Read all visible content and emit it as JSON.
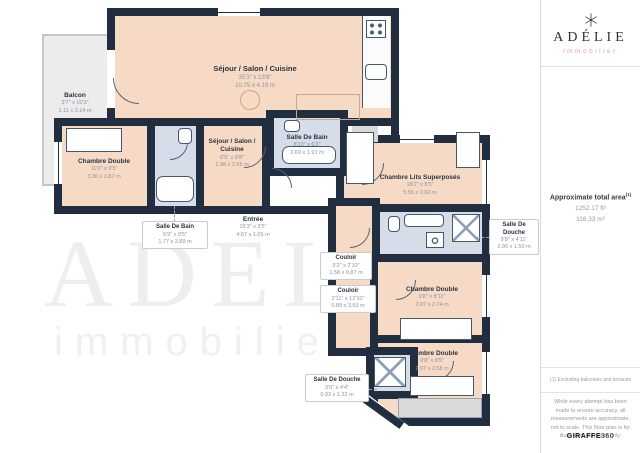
{
  "colors": {
    "wall": "#202e3f",
    "room_peach": "#f7dac5",
    "room_blue": "#d6dde8",
    "balcony_gray": "#ececec",
    "accent_pink": "#d9a3a3"
  },
  "watermark": {
    "line1": "ADELIE",
    "line2": "immobilier"
  },
  "rooms": {
    "balcon": {
      "name": "Balcon",
      "imperial": "3'7\" x 10'3\"",
      "metric": "1.11 x 3.14 m"
    },
    "sejour_main": {
      "name": "Séjour / Salon / Cuisine",
      "imperial": "35'3\" x 13'8\"",
      "metric": "10.75 x 4.19 m"
    },
    "chambre_left": {
      "name": "Chambre Double",
      "imperial": "11'0\" x 9'5\"",
      "metric": "3.36 x 2.87 m"
    },
    "sdb_left": {
      "name": "Salle De Bain",
      "imperial": "5'9\" x 9'5\"",
      "metric": "1.77 x 2.89 m"
    },
    "sejour_small": {
      "name": "Séjour / Salon / Cuisine",
      "imperial": "6'5\" x 8'8\"",
      "metric": "1.98 x 2.65 m"
    },
    "sdb_top": {
      "name": "Salle De Bain",
      "imperial": "8'10\" x 6'3\"",
      "metric": "2.69 x 1.91 m"
    },
    "entree": {
      "name": "Entrée",
      "imperial": "15'3\" x 3'5\"",
      "metric": "4.67 x 1.05 m"
    },
    "lits": {
      "name": "Chambre Lits Superposés",
      "imperial": "18'2\" x 8'5\"",
      "metric": "5.55 x 2.60 m"
    },
    "sdd_right": {
      "name": "Salle De Douche",
      "imperial": "9'8\" x 4'11\"",
      "metric": "2.96 x 1.50 m"
    },
    "couloir1": {
      "name": "Couloir",
      "imperial": "5'2\" x 2'10\"",
      "metric": "1.58 x 0.87 m"
    },
    "couloir2": {
      "name": "Couloir",
      "imperial": "2'11\" x 12'10\"",
      "metric": "0.89 x 3.93 m"
    },
    "chambre_mid": {
      "name": "Chambre Double",
      "imperial": "9'8\" x 8'11\"",
      "metric": "2.97 x 2.74 m"
    },
    "chambre_bottom": {
      "name": "Chambre Double",
      "imperial": "9'8\" x 8'5\"",
      "metric": "2.97 x 2.58 m"
    },
    "sdd_bottom": {
      "name": "Salle De Douche",
      "imperial": "3'0\" x 4'4\"",
      "metric": "0.93 x 1.32 m"
    }
  },
  "sidebar": {
    "brand": {
      "name": "ADÉLIE",
      "tagline": "immobilier"
    },
    "area": {
      "title": "Approximate total area",
      "superscript": "(1)",
      "imperial": "1252.17 ft²",
      "metric": "116.33 m²"
    },
    "footnote": "(1) Excluding balconies and terraces",
    "disclaimer": "While every attempt has been made to ensure accuracy, all measurements are approximate, not to scale. This floor plan is for illustrative purposes only.",
    "credit_bold": "GIRAFFE",
    "credit_rest": "360"
  }
}
